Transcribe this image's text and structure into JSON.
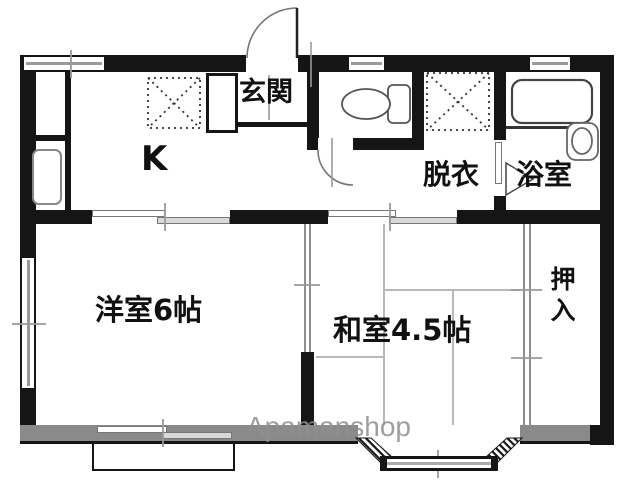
{
  "floorplan": {
    "type": "apartment-floor-plan",
    "labels": {
      "kitchen": "K",
      "entrance": "玄関",
      "dressing": "脱衣",
      "bathroom": "浴室",
      "western_room": "洋室6帖",
      "japanese_room": "和室4.5帖",
      "closet": "押入"
    },
    "watermark": "Apamanshop",
    "colors": {
      "wall": "#151515",
      "exterior_wall_gray": "#8a8a8a",
      "fixture_line": "#555555",
      "tatami_line": "#b8b8b8",
      "watermark": "#8f8f8f"
    },
    "fixtures": [
      "entrance-door-swing",
      "toilet",
      "bathtub",
      "wash-basin",
      "kitchen-appliance",
      "washer-space-kitchen",
      "washer-space-dressing",
      "bay-window",
      "balcony",
      "sliding-doors",
      "closet-fusuma"
    ]
  }
}
